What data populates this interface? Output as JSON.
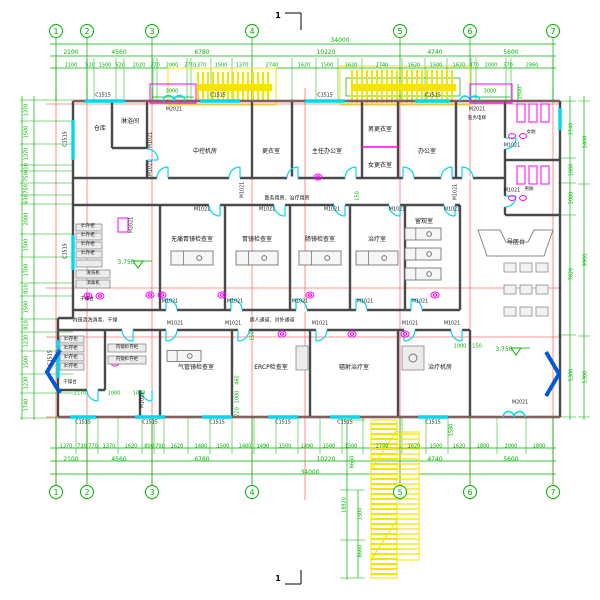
{
  "axes": {
    "numbers": [
      "1",
      "2",
      "3",
      "4",
      "5",
      "6",
      "7"
    ],
    "x": [
      56,
      87,
      152,
      252,
      400,
      470,
      553
    ],
    "top_y": 31,
    "bottom_y": 492
  },
  "groups": [
    {
      "name": "dim-label",
      "cls": "dim",
      "rot": false,
      "items": [
        [
          "34000",
          340,
          41
        ],
        [
          "2100",
          71,
          53
        ],
        [
          "4560",
          119,
          53
        ],
        [
          "6780",
          202,
          53
        ],
        [
          "10220",
          326,
          53
        ],
        [
          "4740",
          435,
          53
        ],
        [
          "5600",
          511,
          53
        ],
        [
          "2100",
          71,
          460
        ],
        [
          "4560",
          119,
          460
        ],
        [
          "6780",
          202,
          460
        ],
        [
          "10220",
          326,
          460
        ],
        [
          "4740",
          435,
          460
        ],
        [
          "5600",
          511,
          460
        ],
        [
          "34000",
          310,
          473
        ]
      ]
    },
    {
      "name": "dim-label",
      "cls": "dim2",
      "rot": false,
      "items": [
        [
          "2100",
          71,
          66
        ],
        [
          "520",
          90,
          66
        ],
        [
          "1500",
          105,
          66
        ],
        [
          "520",
          120,
          66
        ],
        [
          "2020",
          139,
          66
        ],
        [
          "270",
          155,
          66
        ],
        [
          "2000",
          172,
          66
        ],
        [
          "270",
          189,
          66
        ],
        [
          "1370",
          200,
          66
        ],
        [
          "1500",
          221,
          66
        ],
        [
          "1370",
          242,
          66
        ],
        [
          "2740",
          272,
          66
        ],
        [
          "1620",
          304,
          66
        ],
        [
          "1500",
          327,
          66
        ],
        [
          "1620",
          351,
          66
        ],
        [
          "2740",
          382,
          66
        ],
        [
          "1620",
          414,
          66
        ],
        [
          "1500",
          436,
          66
        ],
        [
          "1620",
          459,
          66
        ],
        [
          "370",
          474,
          66
        ],
        [
          "2000",
          491,
          66
        ],
        [
          "370",
          508,
          66
        ],
        [
          "2860",
          532,
          66
        ],
        [
          "1370",
          66,
          447
        ],
        [
          "730",
          82,
          447
        ],
        [
          "770",
          93,
          447
        ],
        [
          "1370",
          109,
          447
        ],
        [
          "1620",
          131,
          447
        ],
        [
          "800",
          149,
          447
        ],
        [
          "700",
          160,
          447
        ],
        [
          "1620",
          177,
          447
        ],
        [
          "1480",
          201,
          447
        ],
        [
          "1500",
          223,
          447
        ],
        [
          "1480",
          245,
          447
        ],
        [
          "1490",
          263,
          447
        ],
        [
          "1500",
          285,
          447
        ],
        [
          "1490",
          307,
          447
        ],
        [
          "1500",
          329,
          447
        ],
        [
          "1500",
          351,
          447
        ],
        [
          "2740",
          382,
          447
        ],
        [
          "1620",
          414,
          447
        ],
        [
          "1500",
          436,
          447
        ],
        [
          "1620",
          459,
          447
        ],
        [
          "1800",
          483,
          447
        ],
        [
          "2000",
          511,
          447
        ],
        [
          "1800",
          539,
          447
        ],
        [
          "3000",
          172,
          92
        ],
        [
          "3000",
          490,
          92
        ],
        [
          "2170",
          80,
          394
        ],
        [
          "1000",
          114,
          394
        ],
        [
          "1070",
          139,
          394
        ],
        [
          "1000",
          460,
          347
        ],
        [
          "150",
          477,
          347
        ]
      ]
    },
    {
      "name": "dim-label",
      "cls": "dimv",
      "rot": true,
      "items": [
        [
          "1370",
          27,
          110
        ],
        [
          "1500",
          27,
          132
        ],
        [
          "1370",
          27,
          154
        ],
        [
          "410",
          27,
          168
        ],
        [
          "750",
          27,
          177
        ],
        [
          "750",
          27,
          189
        ],
        [
          "630",
          27,
          199
        ],
        [
          "2000",
          27,
          219
        ],
        [
          "1500",
          27,
          245
        ],
        [
          "1700",
          27,
          270
        ],
        [
          "810",
          27,
          289
        ],
        [
          "1500",
          27,
          307
        ],
        [
          "810",
          27,
          325
        ],
        [
          "1230",
          27,
          341
        ],
        [
          "1500",
          27,
          362
        ],
        [
          "1230",
          27,
          383
        ],
        [
          "1740",
          27,
          405
        ],
        [
          "3740",
          572,
          129
        ],
        [
          "1660",
          572,
          170
        ],
        [
          "2080",
          572,
          198
        ],
        [
          "7820",
          572,
          274
        ],
        [
          "5300",
          572,
          375
        ],
        [
          "5400",
          586,
          142
        ],
        [
          "9900",
          586,
          260
        ],
        [
          "5300",
          586,
          377
        ],
        [
          "1500",
          521,
          93
        ],
        [
          "462",
          238,
          380
        ],
        [
          "1000",
          238,
          397
        ],
        [
          "220",
          238,
          412
        ],
        [
          "150",
          253,
          336
        ],
        [
          "150",
          358,
          196
        ],
        [
          "1580",
          452,
          430
        ],
        [
          "8660",
          353,
          462
        ],
        [
          "18820",
          345,
          505
        ],
        [
          "1500",
          361,
          514
        ],
        [
          "8660",
          361,
          551
        ]
      ]
    },
    {
      "name": "window-tag",
      "cls": "wtag",
      "rot": false,
      "items": [
        [
          "C1515",
          103,
          97
        ],
        [
          "C1515",
          218,
          97
        ],
        [
          "C1515",
          325,
          97
        ],
        [
          "C1515",
          433,
          97
        ],
        [
          "C1515",
          83,
          424
        ],
        [
          "C1515",
          150,
          424
        ],
        [
          "C1515",
          217,
          424
        ],
        [
          "C1515",
          283,
          424
        ],
        [
          "C1515",
          345,
          424
        ],
        [
          "C1515",
          433,
          424
        ]
      ]
    },
    {
      "name": "window-tag",
      "cls": "wtag",
      "rot": true,
      "items": [
        [
          "C1515",
          67,
          139
        ],
        [
          "C1515",
          67,
          251
        ],
        [
          "C1515",
          52,
          358
        ]
      ]
    },
    {
      "name": "door-tag",
      "cls": "dtag",
      "rot": false,
      "items": [
        [
          "M1021",
          202,
          211
        ],
        [
          "M1021",
          267,
          211
        ],
        [
          "M1021",
          332,
          211
        ],
        [
          "M1021",
          397,
          211
        ],
        [
          "M1021",
          452,
          211
        ],
        [
          "M1021",
          170,
          303
        ],
        [
          "M1021",
          235,
          303
        ],
        [
          "M1021",
          300,
          303
        ],
        [
          "M1021",
          365,
          303
        ],
        [
          "M1021",
          420,
          303
        ],
        [
          "M1021",
          175,
          325
        ],
        [
          "M1021",
          233,
          325
        ],
        [
          "M1021",
          320,
          325
        ],
        [
          "M1021",
          410,
          325
        ],
        [
          "M1021",
          452,
          325
        ],
        [
          "M1021",
          512,
          147
        ],
        [
          "M1021",
          512,
          192
        ],
        [
          "M2021",
          174,
          111
        ],
        [
          "M2021",
          477,
          111
        ],
        [
          "M2021",
          520,
          404
        ]
      ]
    },
    {
      "name": "door-tag",
      "cls": "dtag",
      "rot": true,
      "items": [
        [
          "M1021",
          152,
          140
        ],
        [
          "M1021",
          152,
          168
        ],
        [
          "M1021",
          457,
          192
        ],
        [
          "M2021",
          133,
          225
        ],
        [
          "M1021",
          144,
          400
        ],
        [
          "M1021",
          244,
          190
        ]
      ]
    },
    {
      "name": "room-label",
      "cls": "room",
      "rot": false,
      "items": [
        [
          "仓库",
          100,
          129
        ],
        [
          "淋浴间",
          130,
          122
        ],
        [
          "中控机房",
          205,
          152
        ],
        [
          "更衣室",
          271,
          152
        ],
        [
          "主任办公室",
          327,
          152
        ],
        [
          "男更衣室",
          380,
          130
        ],
        [
          "女更衣室",
          380,
          166
        ],
        [
          "办公室",
          427,
          152
        ],
        [
          "无痛胃镜检查室",
          192,
          240
        ],
        [
          "胃镜检查室",
          257,
          240
        ],
        [
          "肠镜检查室",
          320,
          240
        ],
        [
          "治疗室",
          377,
          240
        ],
        [
          "留观室",
          424,
          222
        ],
        [
          "气管镜检查室",
          196,
          368
        ],
        [
          "ERCP检查室",
          271,
          368
        ],
        [
          "辐射治疗室",
          354,
          368
        ],
        [
          "治疗机房",
          440,
          368
        ],
        [
          "导医台",
          516,
          243
        ]
      ]
    },
    {
      "name": "equip-label",
      "cls": "roomsm",
      "rot": false,
      "items": [
        [
          "医务电梯",
          477,
          119
        ],
        [
          "女厕",
          531,
          133
        ],
        [
          "男厕",
          529,
          190
        ],
        [
          "干燥台",
          87,
          300
        ],
        [
          "干燥台",
          70,
          383
        ],
        [
          "贮存柜",
          88,
          227
        ],
        [
          "贮存柜",
          88,
          236
        ],
        [
          "贮存柜",
          88,
          245
        ],
        [
          "贮存柜",
          88,
          254
        ],
        [
          "清洗机",
          93,
          274
        ],
        [
          "消毒机",
          93,
          284
        ],
        [
          "贮存柜",
          71,
          340
        ],
        [
          "贮存柜",
          71,
          349
        ],
        [
          "贮存柜",
          71,
          358
        ],
        [
          "贮存柜",
          71,
          367
        ],
        [
          "内镜贮存柜",
          127,
          348
        ],
        [
          "内镜贮存柜",
          127,
          360
        ]
      ]
    },
    {
      "name": "corridor-label",
      "cls": "corr",
      "rot": false,
      "items": [
        [
          "医务用房、治疗用房",
          287,
          199
        ],
        [
          "病人通道、对外通道",
          272,
          321
        ],
        [
          "内镜清洗消毒、干燥",
          95,
          321
        ]
      ]
    },
    {
      "name": "elevation-label",
      "cls": "elev",
      "rot": false,
      "items": [
        [
          "3.750",
          126,
          263
        ],
        [
          "3.750",
          504,
          350
        ]
      ]
    },
    {
      "name": "section-mark",
      "cls": "sec",
      "rot": false,
      "items": [
        [
          "1",
          278,
          16
        ],
        [
          "1",
          278,
          579
        ]
      ]
    }
  ]
}
